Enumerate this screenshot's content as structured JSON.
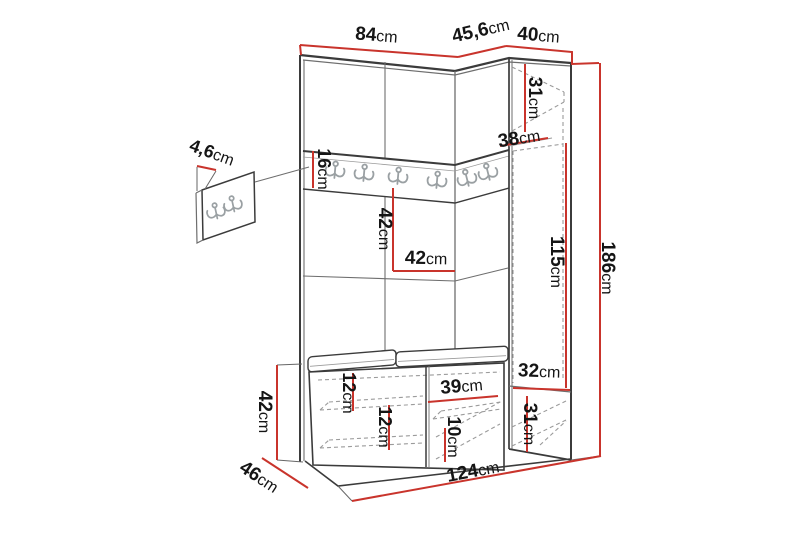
{
  "units": {
    "cm": "cm"
  },
  "dims": {
    "main_top_width": "84",
    "corner_top_width": "45,6",
    "right_top_width": "40",
    "right_top_section_height": "31",
    "right_top_depth": "38",
    "right_door_height": "115",
    "total_height": "186",
    "hook_panel_thickness": "4,6",
    "hook_rail_height": "16",
    "middle_section_height": "42",
    "middle_section_width": "42",
    "bench_height": "42",
    "bench_depth": "46",
    "bench_shelf_top_gap": "12",
    "bench_shelf_gap": "12",
    "bench_right_width": "39",
    "bench_right_gap": "10",
    "right_bottom_width": "32",
    "right_bottom_height": "31",
    "total_width": "124"
  },
  "icons": {
    "rail_coat_hook_count": 6,
    "detail_panel_hook_count": 2
  },
  "colors": {
    "dimension_red": "#c9342c",
    "outline_dark": "#3b3b3b",
    "outline_light": "#9b9b9b",
    "hook_gray": "#9aa0a3",
    "background": "#ffffff"
  }
}
